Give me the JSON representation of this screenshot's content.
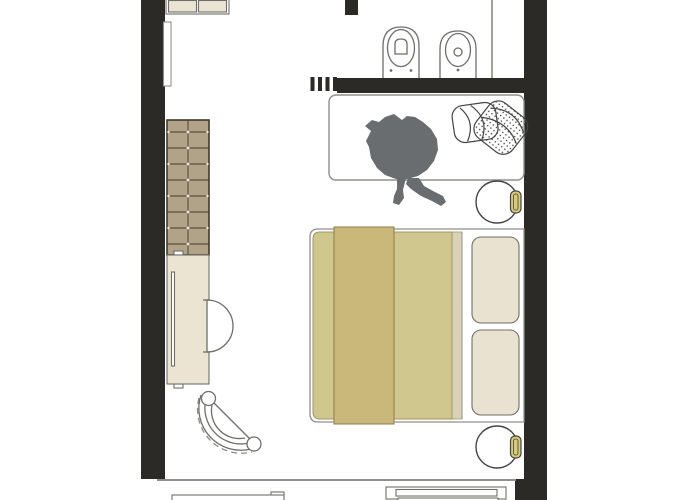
{
  "diagram": {
    "type": "floor-plan",
    "description": "Top-view architectural floor plan of a studio hotel room with bathroom, bed, desk, seating and balcony furniture",
    "rooms": [
      {
        "name": "bathroom",
        "fixtures": [
          "wall-hung-toilet",
          "wall-hung-bidet",
          "shower-niche"
        ]
      },
      {
        "name": "main-room",
        "furniture": [
          "wardrobe-cabinet",
          "wall-panel",
          "tufted-unit",
          "desk",
          "desk-chair",
          "armchair",
          "double-bed",
          "bed-runner",
          "bed-pillows",
          "nightstand-top",
          "nightstand-bottom",
          "lamp-top",
          "lamp-bottom",
          "window-bench",
          "bench-cushions",
          "person-figure"
        ]
      },
      {
        "name": "balcony",
        "furniture": [
          "balcony-table",
          "balcony-lounger"
        ]
      }
    ]
  },
  "colors": {
    "floor": "#ffffff",
    "wall": "#2b2a26",
    "outline": "#6e6e6a",
    "outline-dark": "#444444",
    "line-light": "#8f8f8c",
    "cream": "#ebe4d3",
    "pillow": "#eae2d1",
    "tufted": "#b1a388",
    "tufted-line": "#43382c",
    "duvet": "#cfc78e",
    "duvet-border": "#a39566",
    "runner": "#cab87a",
    "runner-border": "#8d7c4a",
    "sheet": "#d9d2b6",
    "lamp": "#d5cb78",
    "person": "#696d70"
  }
}
